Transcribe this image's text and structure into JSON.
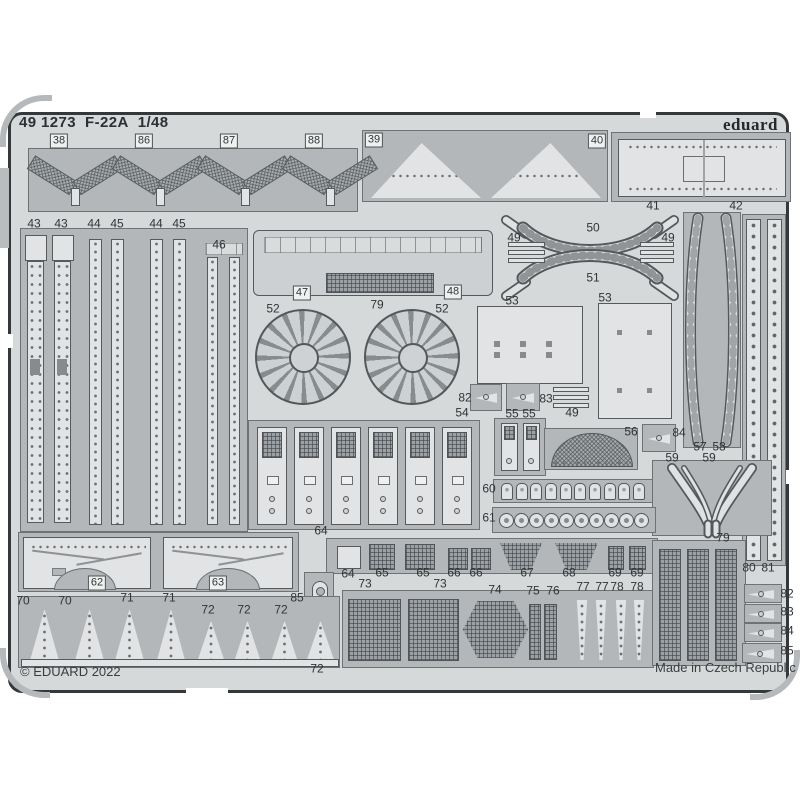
{
  "header": {
    "catalog_number": "49 1273",
    "kit_name": "F-22A",
    "scale": "1/48",
    "brand": "eduard"
  },
  "footer": {
    "copyright": "© EDUARD 2022",
    "made_in": "Made in Czech Republic"
  },
  "colors": {
    "sheet": "#d6d9da",
    "frame": "#b3b7b9",
    "part": "#e1e3e4",
    "edge": "#35383a",
    "text": "#313437"
  },
  "labels": [
    [
      "38",
      59,
      141,
      1
    ],
    [
      "86",
      144,
      141,
      1
    ],
    [
      "87",
      229,
      141,
      1
    ],
    [
      "88",
      314,
      141,
      1
    ],
    [
      "39",
      374,
      140,
      1
    ],
    [
      "40",
      597,
      141,
      1
    ],
    [
      "41",
      653,
      206,
      0
    ],
    [
      "42",
      736,
      206,
      0
    ],
    [
      "43",
      34,
      224,
      0
    ],
    [
      "43",
      61,
      224,
      0
    ],
    [
      "44",
      94,
      224,
      0
    ],
    [
      "45",
      117,
      224,
      0
    ],
    [
      "44",
      156,
      224,
      0
    ],
    [
      "45",
      179,
      224,
      0
    ],
    [
      "46",
      219,
      245,
      0
    ],
    [
      "47",
      302,
      293,
      1
    ],
    [
      "48",
      453,
      292,
      1
    ],
    [
      "79",
      377,
      305,
      0
    ],
    [
      "52",
      273,
      309,
      0
    ],
    [
      "52",
      442,
      309,
      0
    ],
    [
      "49",
      514,
      238,
      0
    ],
    [
      "50",
      593,
      228,
      0
    ],
    [
      "51",
      593,
      278,
      0
    ],
    [
      "49",
      668,
      238,
      0
    ],
    [
      "53",
      512,
      301,
      0
    ],
    [
      "53",
      605,
      298,
      0
    ],
    [
      "82",
      465,
      398,
      0
    ],
    [
      "83",
      546,
      399,
      0
    ],
    [
      "49",
      572,
      413,
      0
    ],
    [
      "54",
      462,
      413,
      0
    ],
    [
      "55",
      512,
      414,
      0
    ],
    [
      "55",
      529,
      414,
      0
    ],
    [
      "56",
      631,
      432,
      0
    ],
    [
      "84",
      679,
      433,
      0
    ],
    [
      "57",
      700,
      447,
      0
    ],
    [
      "58",
      719,
      447,
      0
    ],
    [
      "59",
      672,
      458,
      0
    ],
    [
      "59",
      709,
      458,
      0
    ],
    [
      "60",
      489,
      489,
      0
    ],
    [
      "61",
      489,
      518,
      0
    ],
    [
      "64",
      321,
      531,
      0
    ],
    [
      "62",
      97,
      583,
      1
    ],
    [
      "63",
      218,
      583,
      1
    ],
    [
      "80",
      749,
      568,
      0
    ],
    [
      "81",
      768,
      568,
      0
    ],
    [
      "64",
      348,
      574,
      0
    ],
    [
      "65",
      382,
      573,
      0
    ],
    [
      "65",
      423,
      573,
      0
    ],
    [
      "66",
      454,
      573,
      0
    ],
    [
      "66",
      476,
      573,
      0
    ],
    [
      "67",
      527,
      573,
      0
    ],
    [
      "68",
      569,
      573,
      0
    ],
    [
      "69",
      615,
      573,
      0
    ],
    [
      "69",
      637,
      573,
      0
    ],
    [
      "73",
      365,
      584,
      0
    ],
    [
      "73",
      440,
      584,
      0
    ],
    [
      "74",
      495,
      590,
      0
    ],
    [
      "75",
      533,
      591,
      0
    ],
    [
      "76",
      553,
      591,
      0
    ],
    [
      "77",
      583,
      587,
      0
    ],
    [
      "77",
      602,
      587,
      0
    ],
    [
      "78",
      617,
      587,
      0
    ],
    [
      "78",
      637,
      587,
      0
    ],
    [
      "85",
      297,
      598,
      0
    ],
    [
      "70",
      23,
      601,
      0
    ],
    [
      "70",
      65,
      601,
      0
    ],
    [
      "71",
      127,
      598,
      0
    ],
    [
      "71",
      169,
      598,
      0
    ],
    [
      "72",
      208,
      610,
      0
    ],
    [
      "72",
      244,
      610,
      0
    ],
    [
      "72",
      281,
      610,
      0
    ],
    [
      "72",
      317,
      669,
      0
    ],
    [
      "79",
      723,
      538,
      0
    ],
    [
      "82",
      787,
      594,
      0
    ],
    [
      "83",
      787,
      612,
      0
    ],
    [
      "84",
      787,
      631,
      0
    ],
    [
      "85",
      787,
      651,
      0
    ]
  ]
}
